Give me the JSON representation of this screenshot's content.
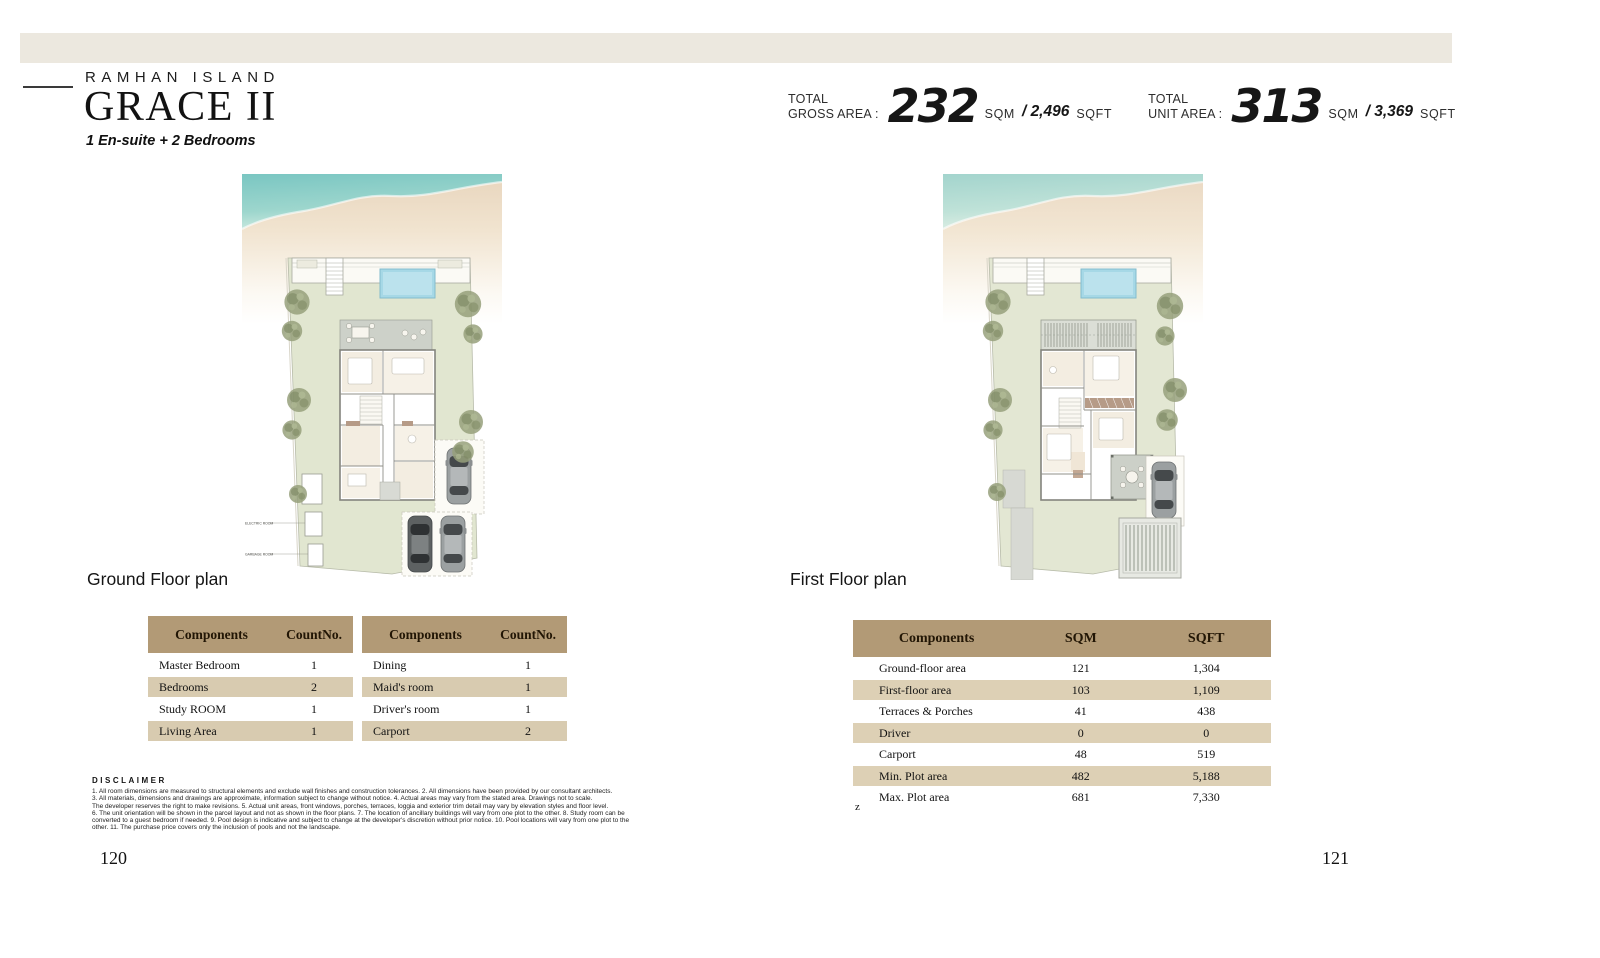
{
  "header": {
    "project": "RAMHAN ISLAND",
    "title": "GRACE II",
    "subtitle": "1 En-suite + 2 Bedrooms"
  },
  "stats": {
    "gross": {
      "label_top": "TOTAL",
      "label_bottom": "GROSS AREA :",
      "value": "232",
      "unit1": "SQM",
      "value2": "/ 2,496",
      "unit2": "SQFT"
    },
    "unit": {
      "label_top": "TOTAL",
      "label_bottom": "UNIT AREA :",
      "value": "313",
      "unit1": "SQM",
      "value2": "/ 3,369",
      "unit2": "SQFT"
    }
  },
  "plans": {
    "ground": {
      "caption": "Ground Floor plan",
      "annotations": {
        "electric_room": "ELECTRIC ROOM",
        "garbage_room": "GARBAGE ROOM"
      }
    },
    "first": {
      "caption": "First Floor plan"
    }
  },
  "tables": {
    "components_left": {
      "headers": [
        "Components",
        "CountNo."
      ],
      "rows": [
        [
          "Master Bedroom",
          "1"
        ],
        [
          "Bedrooms",
          "2"
        ],
        [
          "Study ROOM",
          "1"
        ],
        [
          "Living Area",
          "1"
        ]
      ]
    },
    "components_right": {
      "headers": [
        "Components",
        "CountNo."
      ],
      "rows": [
        [
          "Dining",
          "1"
        ],
        [
          "Maid's room",
          "1"
        ],
        [
          "Driver's room",
          "1"
        ],
        [
          "Carport",
          "2"
        ]
      ]
    },
    "areas": {
      "headers": [
        "Components",
        "SQM",
        "SQFT"
      ],
      "rows": [
        [
          "Ground-floor area",
          "121",
          "1,304"
        ],
        [
          "First-floor area",
          "103",
          "1,109"
        ],
        [
          "Terraces & Porches",
          "41",
          "438"
        ],
        [
          "Driver",
          "0",
          "0"
        ],
        [
          "Carport",
          "48",
          "519"
        ],
        [
          "Min. Plot area",
          "482",
          "5,188"
        ],
        [
          "Max. Plot area",
          "681",
          "7,330"
        ]
      ],
      "footnote": "z"
    }
  },
  "disclaimer": {
    "title": "DISCLAIMER",
    "lines": [
      "1. All room dimensions are measured to structural elements and exclude wall finishes and construction tolerances. 2. All dimensions have been provided by our consultant architects.",
      "3. All materials, dimensions and drawings are approximate, information subject to change without notice. 4. Actual areas may vary from the stated area. Drawings not to scale.",
      "The developer reserves the right to make revisions. 5. Actual unit areas, front windows, porches, terraces, loggia and exterior trim detail may vary by elevation styles and floor level.",
      "6. The unit orientation will be shown in the parcel layout and not as shown in the floor plans. 7. The location of ancillary buildings will vary from one plot to the other. 8. Study room can be",
      "converted to a guest bedroom if needed. 9. Pool design is indicative and subject to change at the developer's discretion without prior notice. 10. Pool locations will vary from one plot to the",
      "other. 11. The purchase price covers only the inclusion of pools and not the landscape."
    ]
  },
  "page": {
    "left_number": "120",
    "right_number": "121"
  },
  "colors": {
    "top_band": "#ece8df",
    "table_header_bg": "#b29a76",
    "row_shade_left": "#d8cbb0",
    "row_shade_right": "#ddd0b5",
    "lawn": "#e1e6d0",
    "water": "#7ac6c2",
    "pool": "#a6d8e6"
  }
}
